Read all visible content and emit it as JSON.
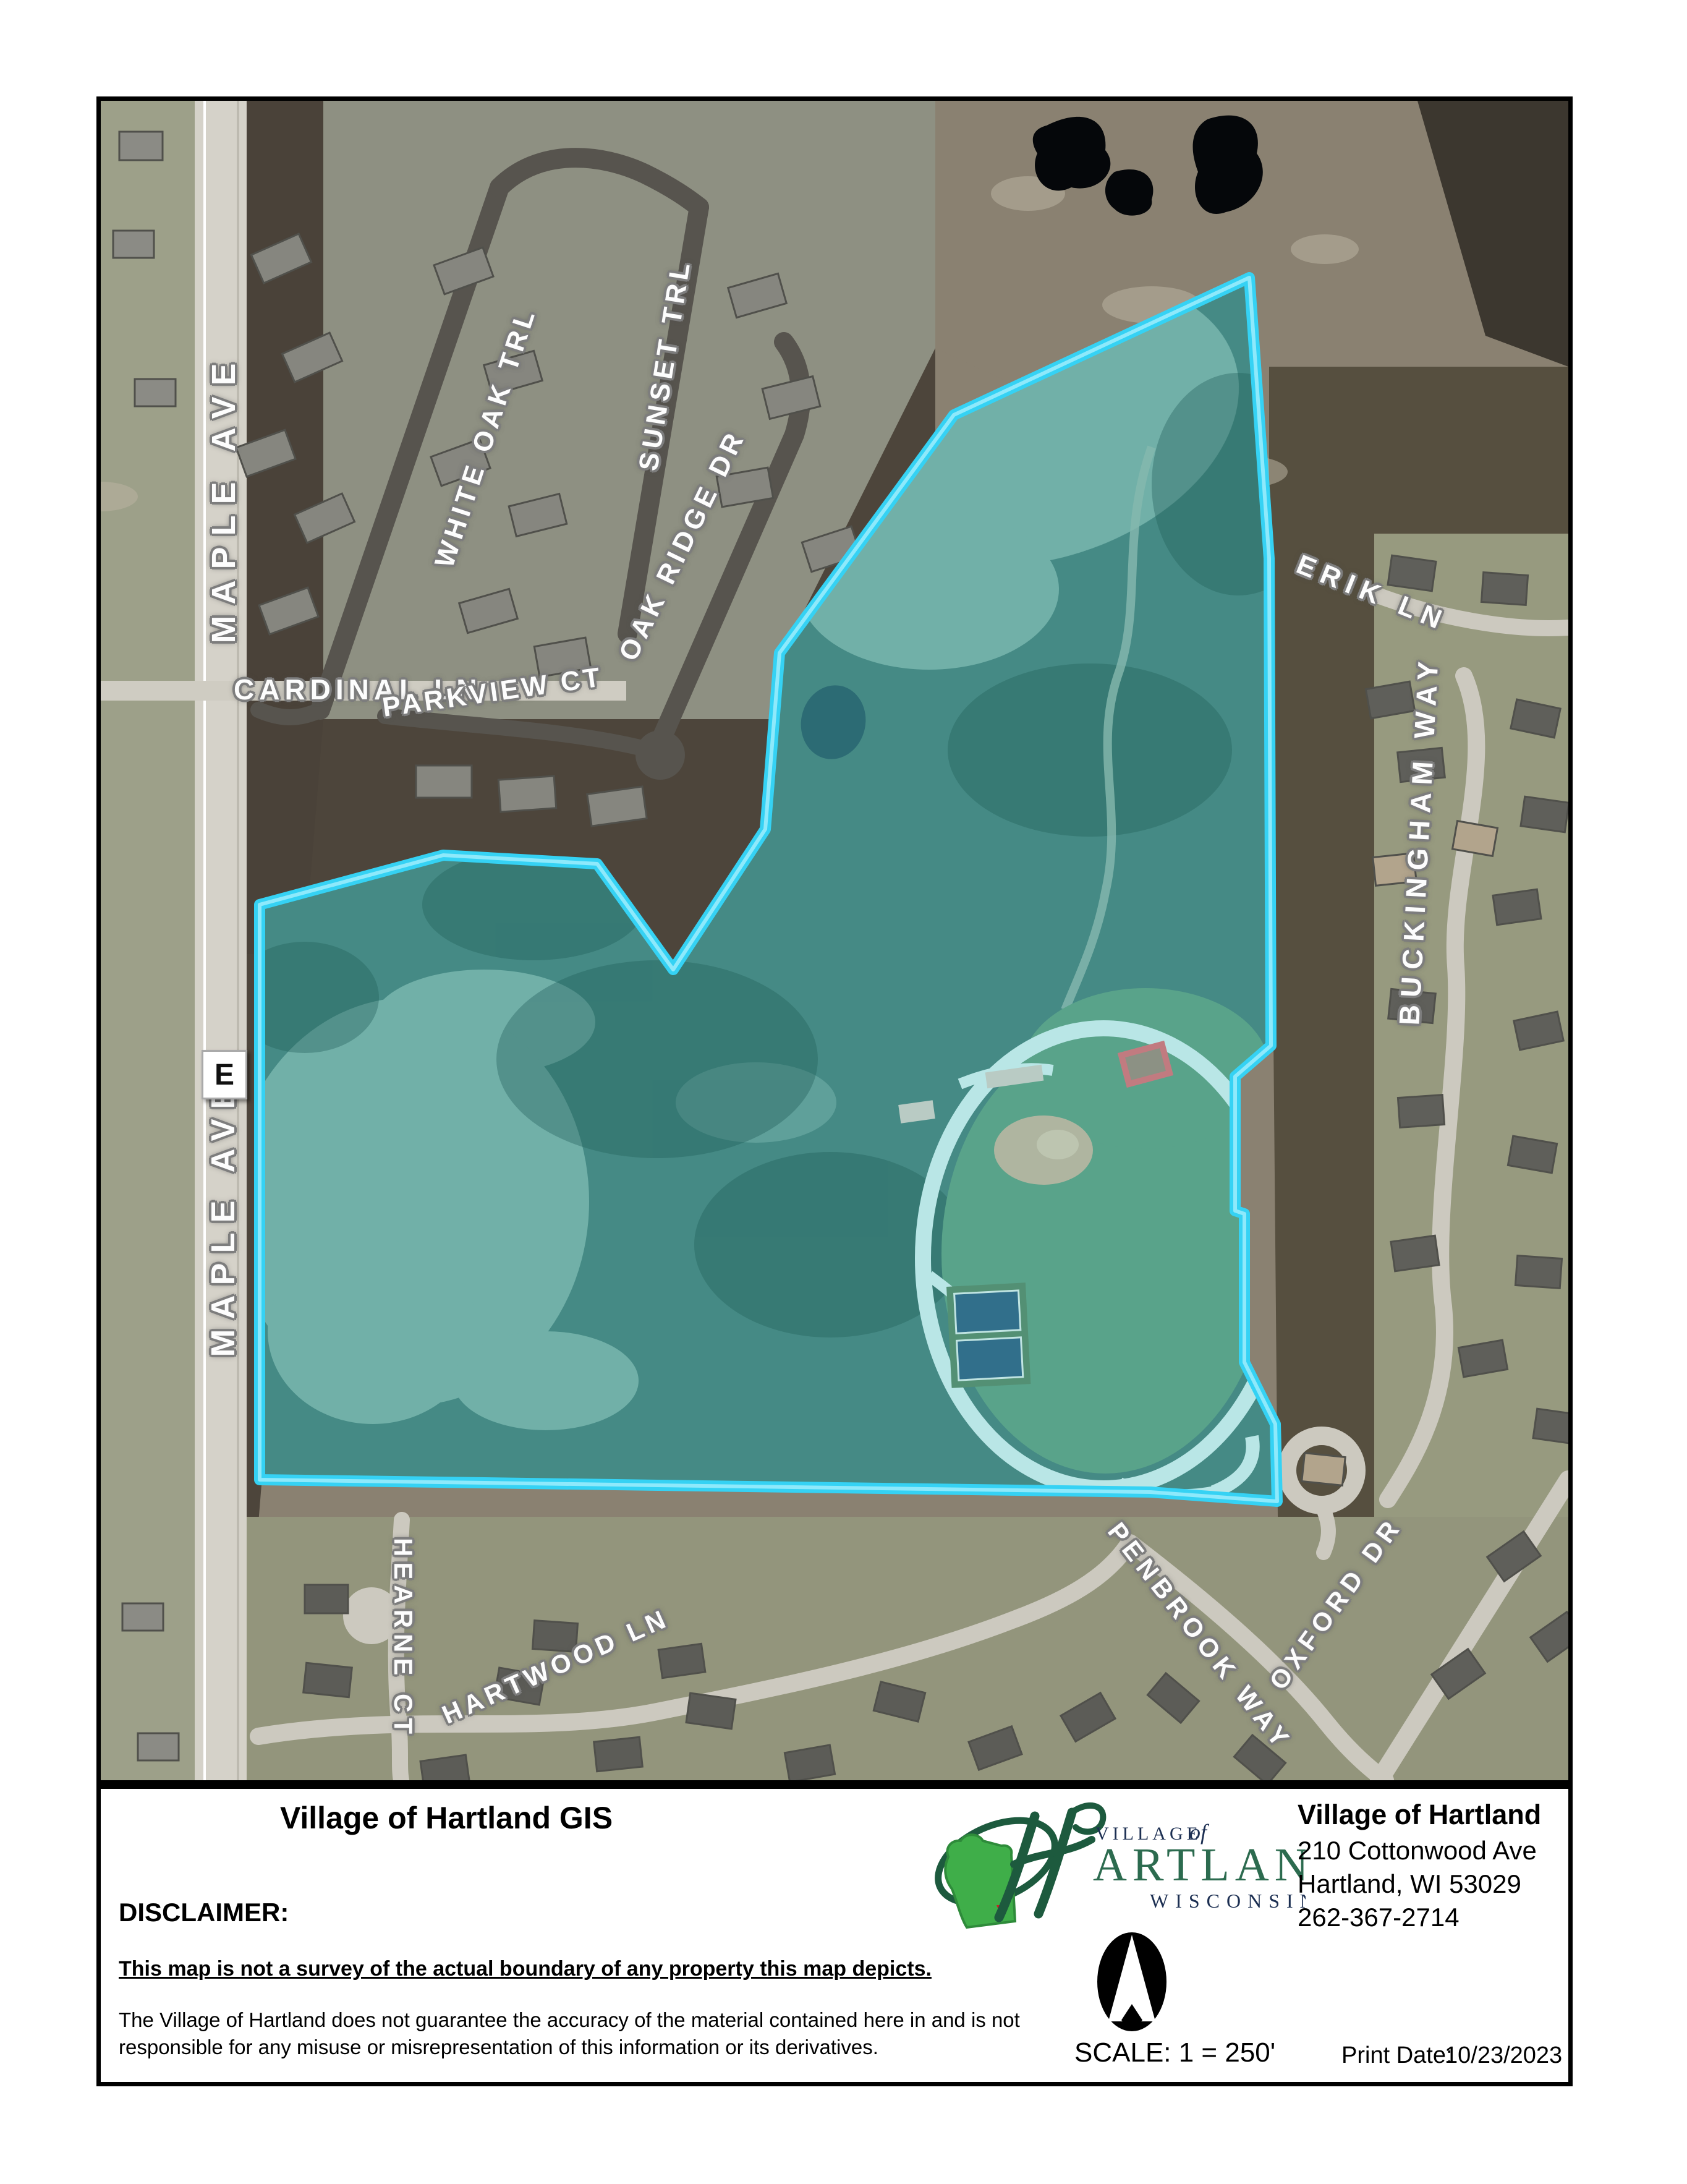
{
  "map": {
    "highway_marker": "E",
    "boundary_color": "#35D2F4",
    "labels": {
      "maple_ave_north": "MAPLE AVE",
      "white_oak_trl": "WHITE OAK TRL",
      "sunset_trl": "SUNSET TRL",
      "oak_ridge_dr": "OAK RIDGE DR",
      "cardinal_ln": "CARDINAL LN",
      "parkview_ct": "PARKVIEW CT",
      "erik_ln": "ERIK LN",
      "buckingham_way": "BUCKINGHAM WAY",
      "maple_ave_south": "MAPLE AVE",
      "hearne_ct": "HEARNE CT",
      "hartwood_ln": "HARTWOOD LN",
      "penbrook_way": "PENBROOK WAY",
      "oxford_dr": "OXFORD DR"
    }
  },
  "footer": {
    "title": "Village of Hartland GIS",
    "disclaimer_label": "DISCLAIMER:",
    "disclaimer_statement": "This map is not a survey of the actual boundary of any property this map depicts.",
    "disclaimer_body": "The Village of Hartland does not guarantee the accuracy of the material contained here in and is not responsible for any misuse or misrepresentation of this information or its derivatives.",
    "scale_text": "SCALE: 1 = 250'",
    "print_date_label": "Print Date:",
    "print_date_value": "10/23/2023",
    "organization": {
      "name": "Village of Hartland",
      "address_line1": "210 Cottonwood Ave",
      "address_line2": "Hartland, WI 53029",
      "phone": "262-367-2714"
    },
    "logo": {
      "initial": "H",
      "village": "VILLAGE",
      "of": "of",
      "artland": "ARTLAND",
      "state_name": "WISCONSIN",
      "green": "#2C6B4F",
      "navy": "#1C2F52"
    }
  }
}
